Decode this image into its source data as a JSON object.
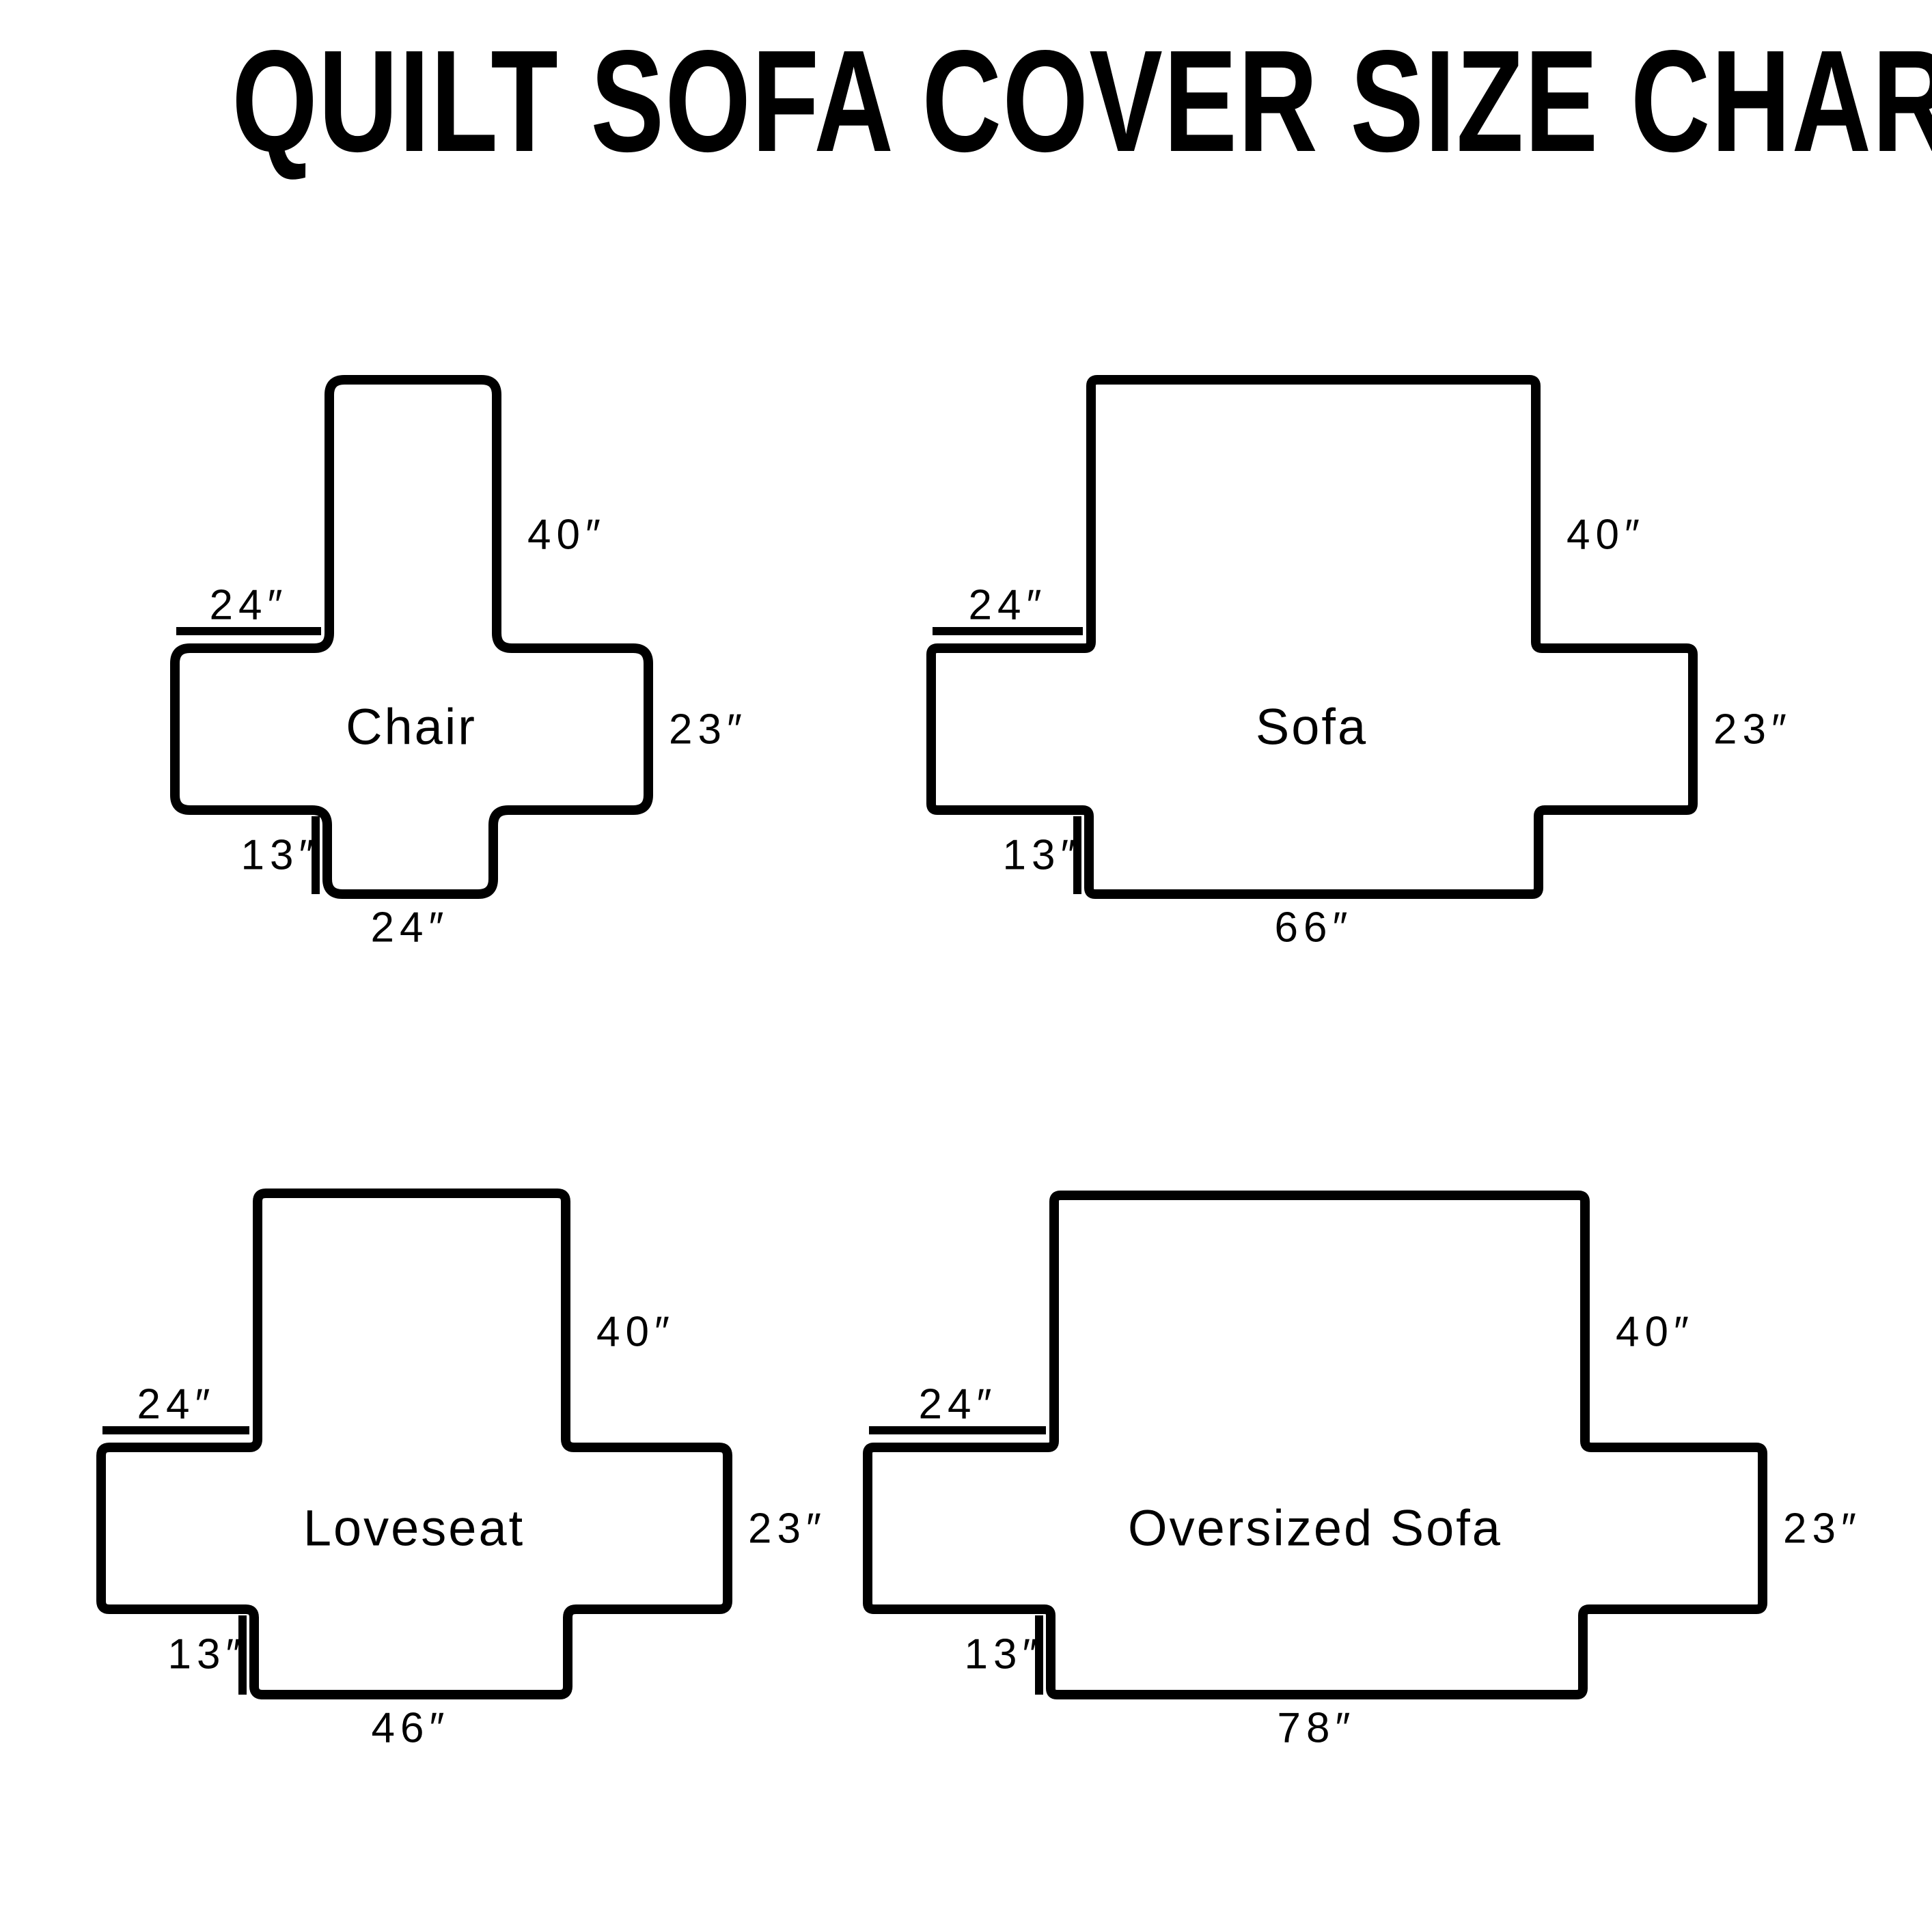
{
  "title": "QUILT SOFA COVER SIZE CHART",
  "colors": {
    "ink": "#000000",
    "background": "#ffffff"
  },
  "diagrams": [
    {
      "label": "Chair",
      "dims": {
        "back": "40″",
        "arm": "24″",
        "side": "23″",
        "front": "13″",
        "bottom": "24″"
      }
    },
    {
      "label": "Sofa",
      "dims": {
        "back": "40″",
        "arm": "24″",
        "side": "23″",
        "front": "13″",
        "bottom": "66″"
      }
    },
    {
      "label": "Loveseat",
      "dims": {
        "back": "40″",
        "arm": "24″",
        "side": "23″",
        "front": "13″",
        "bottom": "46″"
      }
    },
    {
      "label": "Oversized Sofa",
      "dims": {
        "back": "40″",
        "arm": "24″",
        "side": "23″",
        "front": "13″",
        "bottom": "78″"
      }
    }
  ]
}
